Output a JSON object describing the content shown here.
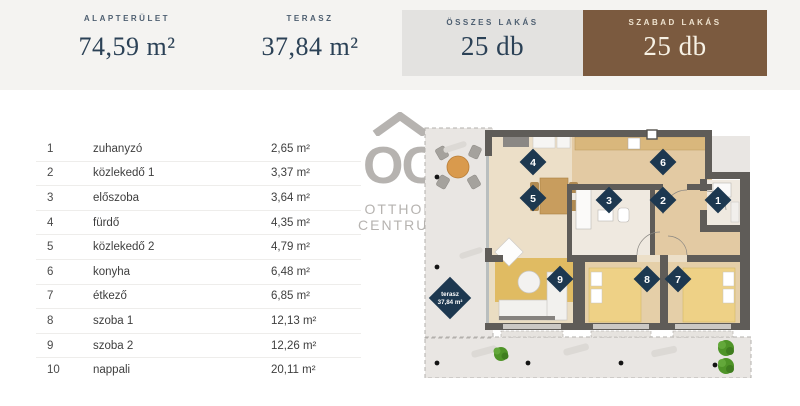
{
  "stats": [
    {
      "label": "ALAPTERÜLET",
      "value": "74,59 m²"
    },
    {
      "label": "TERASZ",
      "value": "37,84 m²"
    }
  ],
  "filters": [
    {
      "label": "ÖSSZES LAKÁS",
      "value": "25 db",
      "active": false
    },
    {
      "label": "SZABAD LAKÁS",
      "value": "25 db",
      "active": true
    }
  ],
  "room_table": {
    "rows": [
      {
        "num": "1",
        "name": "zuhanyzó",
        "area": "2,65 m²"
      },
      {
        "num": "2",
        "name": "közlekedő 1",
        "area": "3,37 m²"
      },
      {
        "num": "3",
        "name": "előszoba",
        "area": "3,64 m²"
      },
      {
        "num": "4",
        "name": "fürdő",
        "area": "4,35 m²"
      },
      {
        "num": "5",
        "name": "közlekedő 2",
        "area": "4,79 m²"
      },
      {
        "num": "6",
        "name": "konyha",
        "area": "6,48 m²"
      },
      {
        "num": "7",
        "name": "étkező",
        "area": "6,85 m²"
      },
      {
        "num": "8",
        "name": "szoba 1",
        "area": "12,13 m²"
      },
      {
        "num": "9",
        "name": "szoba 2",
        "area": "12,26 m²"
      },
      {
        "num": "10",
        "name": "nappali",
        "area": "20,11 m²"
      }
    ]
  },
  "floorplan": {
    "watermark": {
      "logo": "OC",
      "name_line1": "OTTHON",
      "name_line2": "CENTRUM"
    },
    "terrace_badge": {
      "name": "terasz",
      "area": "37,84 m²"
    },
    "room_markers": [
      "1",
      "2",
      "3",
      "4",
      "5",
      "6",
      "7",
      "8",
      "9"
    ]
  },
  "colors": {
    "navy_text": "#2b4156",
    "brown_active": "#7b5a3f",
    "header_bg": "#f4f3f1",
    "filter_inactive_bg": "#e3e2e0",
    "marker_navy": "#1d3850",
    "wall_gray": "#5f5c58",
    "floor_beige": "#ecdfc8",
    "floor_tan": "#e3caa3",
    "ground_gray": "#e9e6e3",
    "watermark_gray": "#b6b3b0"
  }
}
